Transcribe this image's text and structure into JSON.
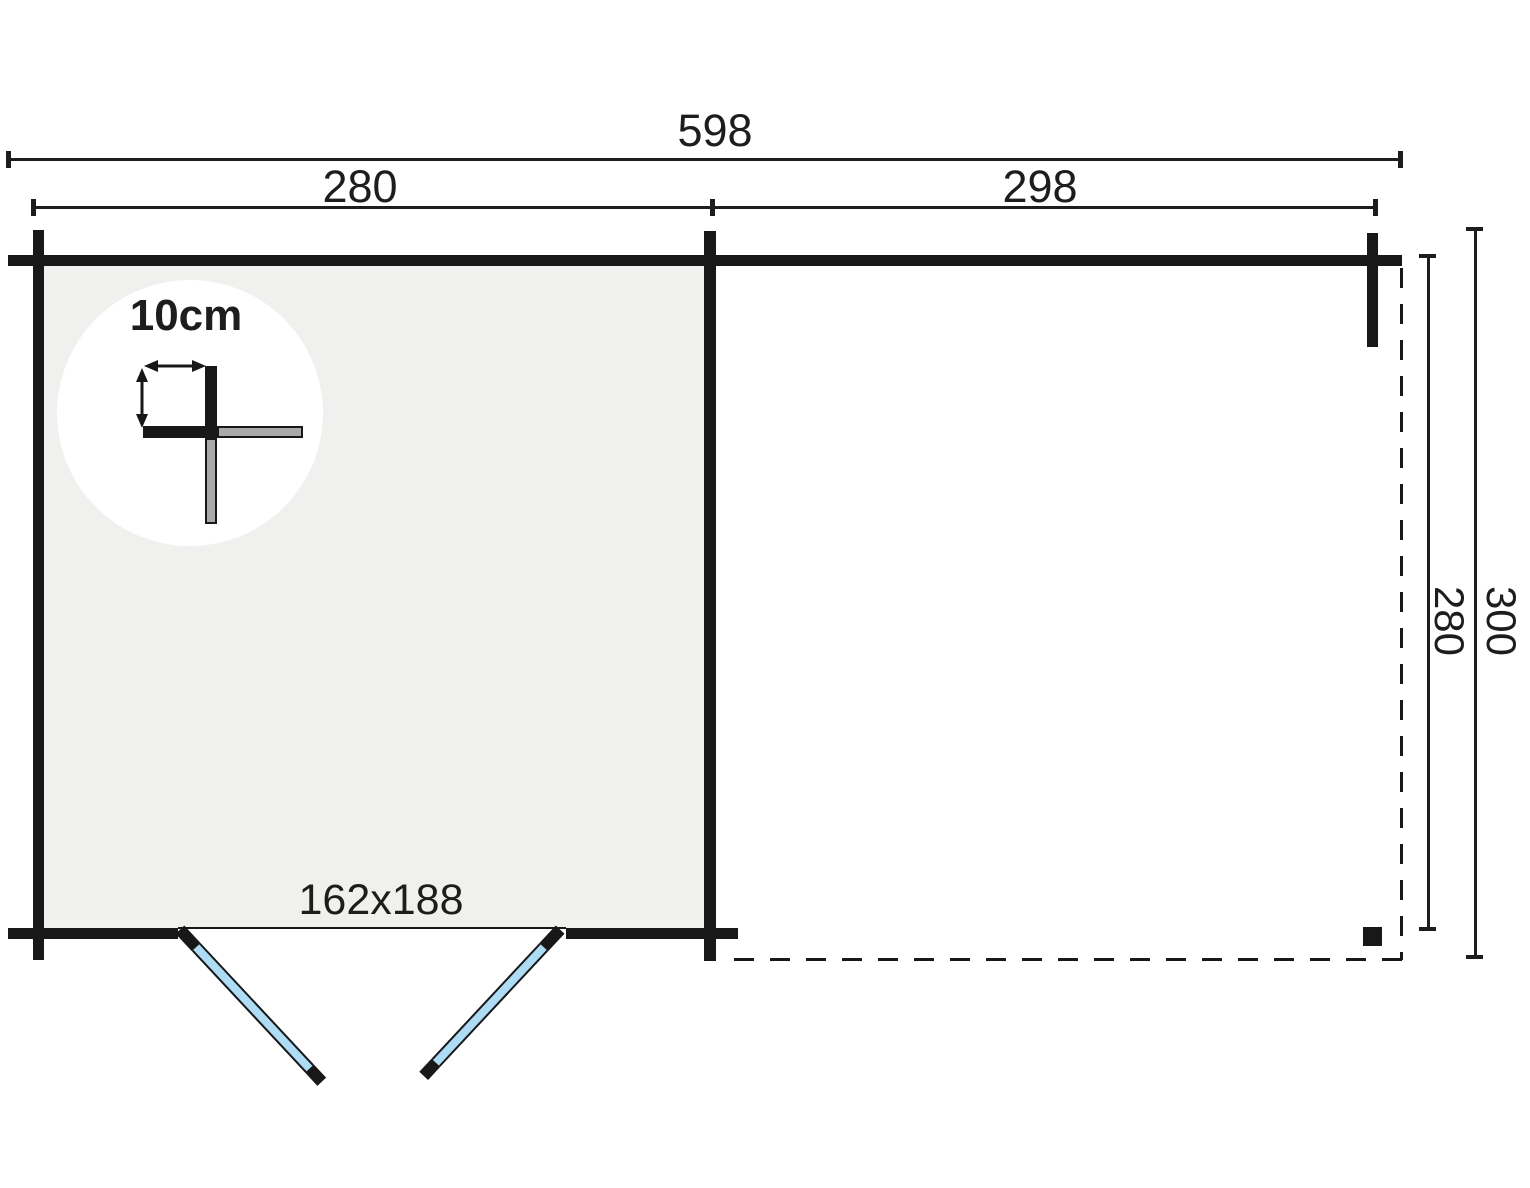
{
  "dimensions": {
    "overall_width": "598",
    "cabin_width": "280",
    "annex_width": "298",
    "inner_depth": "280",
    "overall_depth": "300",
    "door_opening": "162x188",
    "wall_thickness": "10cm"
  },
  "colors": {
    "background": "#ffffff",
    "wall": "#181818",
    "dimension_line": "#1d1d1b",
    "room_fill": "#f0f0ef",
    "door_glass": "#aedcf5",
    "detail_gray": "#a9a9a9"
  }
}
